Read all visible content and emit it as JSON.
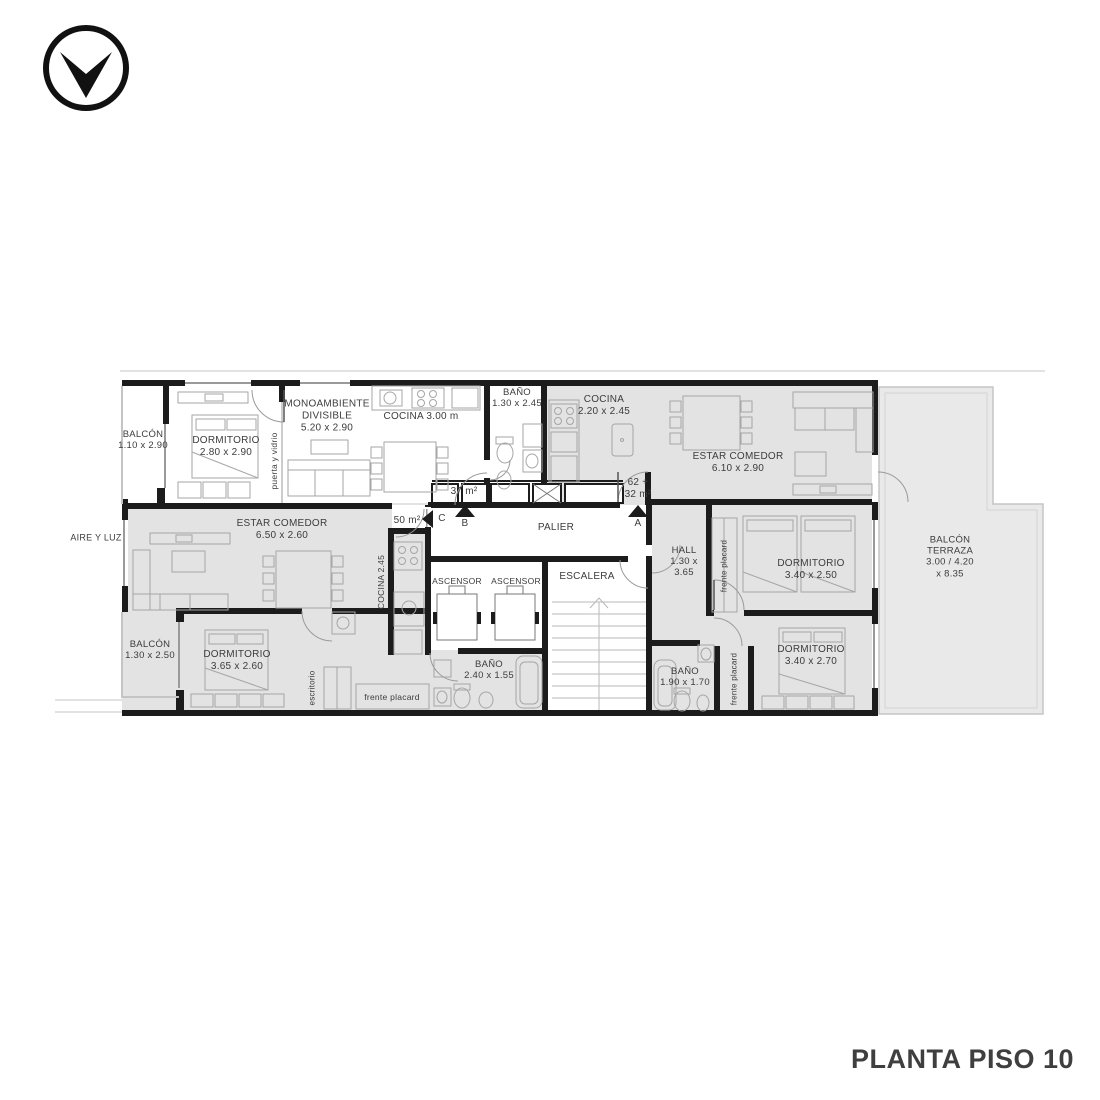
{
  "title": "PLANTA PISO 10",
  "logo": {
    "icon": "down-arrow-in-circle"
  },
  "rooms": {
    "balcon_tl": {
      "l1": "BALCÓN",
      "l2": "1.10 x 2.90"
    },
    "dorm_tl": {
      "l1": "DORMITORIO",
      "l2": "2.80 x 2.90"
    },
    "mono": {
      "l1": "MONOAMBIENTE",
      "l2": "DIVISIBLE",
      "l3": "5.20 x 2.90"
    },
    "cocina_top": {
      "l1": "COCINA 3.00 m"
    },
    "bano_top": {
      "l1": "BAÑO",
      "l2": "1.30 x 2.45"
    },
    "cocina_r": {
      "l1": "COCINA",
      "l2": "2.20 x 2.45"
    },
    "estar_r": {
      "l1": "ESTAR COMEDOR",
      "l2": "6.10 x 2.90"
    },
    "estar_l": {
      "l1": "ESTAR COMEDOR",
      "l2": "6.50 x 2.60"
    },
    "cocina_m": {
      "l1": "COCINA 2.45"
    },
    "palier": {
      "l1": "PALIER"
    },
    "ascensor1": {
      "l1": "ASCENSOR"
    },
    "ascensor2": {
      "l1": "ASCENSOR"
    },
    "escalera": {
      "l1": "ESCALERA"
    },
    "hall": {
      "l1": "HALL",
      "l2": "1.30 x",
      "l3": "3.65"
    },
    "placard_rt": {
      "l1": "frente placard"
    },
    "dorm_rt": {
      "l1": "DORMITORIO",
      "l2": "3.40 x 2.50"
    },
    "terraza": {
      "l1": "BALCÓN",
      "l2": "TERRAZA",
      "l3": "3.00 / 4.20",
      "l4": "x 8.35"
    },
    "balcon_l": {
      "l1": "BALCÓN",
      "l2": "1.30 x 2.50"
    },
    "dorm_l": {
      "l1": "DORMITORIO",
      "l2": "3.65 x 2.60"
    },
    "escritorio": {
      "l1": "escritorio"
    },
    "placard_lb": {
      "l1": "frente placard"
    },
    "bano_m": {
      "l1": "BAÑO",
      "l2": "2.40 x 1.55"
    },
    "bano_r": {
      "l1": "BAÑO",
      "l2": "1.90 x 1.70"
    },
    "placard_rb": {
      "l1": "frente placard"
    },
    "dorm_rb": {
      "l1": "DORMITORIO",
      "l2": "3.40 x 2.70"
    }
  },
  "annotations": {
    "aire_y_luz": "AIRE Y LUZ",
    "puerta_y_vidrio": "puerta y vidrio",
    "area_unit_top": "37 m²",
    "area_unit_left": "50 m²",
    "area_unit_right_1": "62 +",
    "area_unit_right_2": "32 m²"
  },
  "markers": {
    "a": "A",
    "b": "B",
    "c": "C"
  },
  "colors": {
    "wall": "#1c1c1c",
    "room_fill": "#e3e3e3",
    "terrace_fill": "#e9e9e9",
    "furniture_line": "#a6a6a6",
    "text": "#3c3c3c"
  }
}
